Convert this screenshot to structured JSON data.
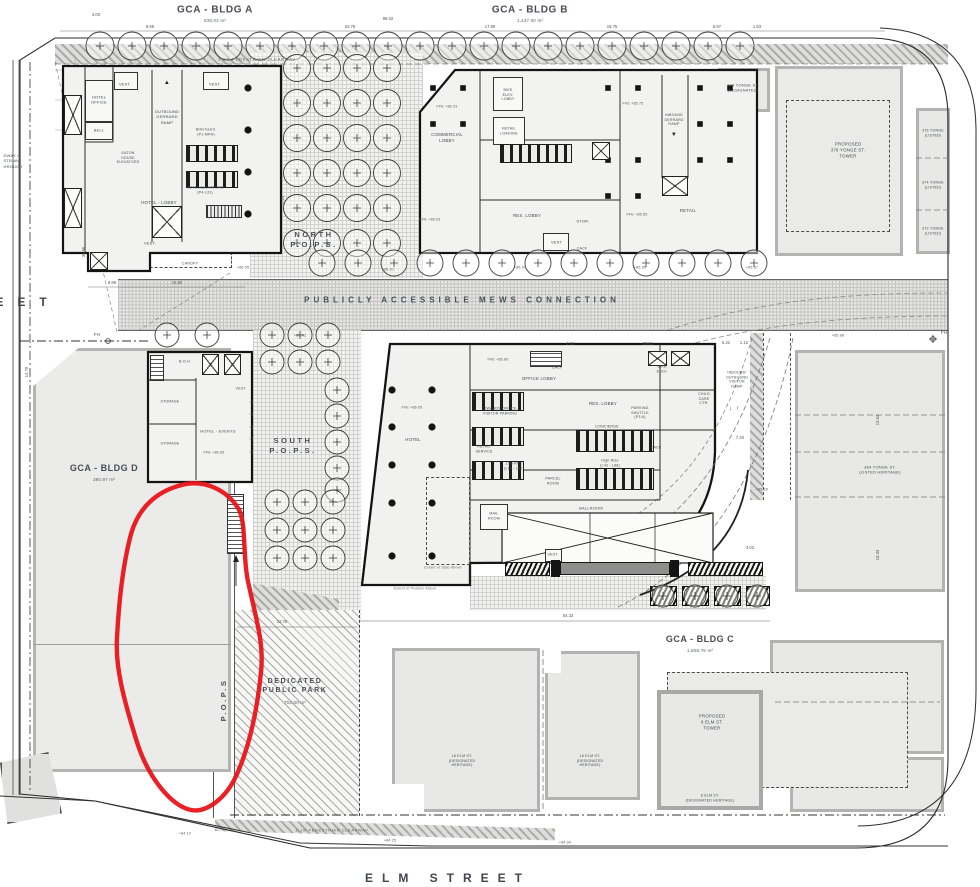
{
  "annotation": {
    "shape": "freehand-ellipse",
    "color": "#E8141A"
  },
  "palette": {
    "wall": "#141414",
    "heritage_border": "#AFAFAD",
    "paper": "#FFFFFF"
  },
  "headers": {
    "bldgA": "GCA - BLDG A",
    "bldgA_area": "838.02 m²",
    "bldgB": "GCA - BLDG B",
    "bldgB_area": "1,437.00 m²",
    "bldgC": "GCA - BLDG C",
    "bldgC_area": "1,808.76 m²",
    "bldgD": "GCA - BLDG D",
    "bldgD_area": "380.97 m²"
  },
  "streets": {
    "elm": "ELM STREET",
    "left_fragment": "EET",
    "left_note": "DWAY /\nSTRIAN\nHROUGH"
  },
  "zones": {
    "mews": "PUBLICLY ACCESSIBLE MEWS CONNECTION",
    "north_pops": "NORTH\nP.O.P.S.",
    "south_pops": "SOUTH\nP.O.P.S.",
    "west_pops": "P.O.P.S",
    "park": "DEDICATED\nPUBLIC PARK",
    "park_area": "702.00 m²",
    "clearway_top": "3.0m PEDESTRIAN CLEARWAY",
    "clearway_bottom": "2.1m PEDESTRIAN CLEARWAY",
    "fh": "FH"
  },
  "bldgA": {
    "rooms": {
      "hotel_office": "HOTEL\nOFFICE",
      "bell": "BELL",
      "vest_nw": "VEST.",
      "vest_ne": "VEST.",
      "vest_s": "VEST.",
      "outbound_ramp": "OUTBOUND\nGERRARD\nRAMP",
      "boh_elev": "BOH ELEV.\n(P1-MPH)",
      "eaton_elev": "EATON\nHOUSE\nELEVATORS",
      "hotel_elev": "HOTEL ELEVATORS\n(P4-L31)",
      "hotel_lobby": "HOTEL - LOBBY",
      "canopy": "CANOPY"
    }
  },
  "bldgB": {
    "rooms": {
      "commercial_lobby": "COMMERCIAL LOBBY",
      "bike_elev_lobby": "BIKE\nELEV.\nLOBBY",
      "retail_loading": "RETAIL\nLOADING",
      "res_lobby": "RES. LOBBY",
      "vest": "VEST.",
      "stor": "STOR.",
      "cacf": "CACF",
      "retail": "RETAIL",
      "inbound_ramp": "INBOUND\nGERRARD\nRAMP"
    }
  },
  "tower": {
    "rooms": {
      "hotel": "HOTEL",
      "office_lobby": "OFFICE LOBBY",
      "towards_office": "TOWARDS OFFICE /\nVISITOR PARKING",
      "retail_service": "RETAIL\nSERVICE",
      "low_rise": "Low-Rise\n(L17 - L42)",
      "high_rise": "High Rise\n(L43 - L88)",
      "res_lobby": "RES. LOBBY",
      "concierge": "CONCIERGE",
      "parking_shuttle": "PARKING\nSHUTTLE\n(P3-6)",
      "child_care": "CHILD\nCARE\nCTR.",
      "bike_elev": "BIKE\nELEV.",
      "cacf1": "CACF",
      "cacf2": "CACF",
      "parcel_room": "PARCEL\nROOM",
      "mail_room": "MAIL\nROOM",
      "ballroom": "BALLROOM",
      "vest": "VEST.",
      "visitor_ramp": "INBOUND/\nOUTBOUND\nVISITOR\nRAMP",
      "extent_podium": "Extent of Podium Above",
      "extent_slab": "Extent of Slab Above"
    }
  },
  "bldgD": {
    "rooms": {
      "boh": "B.O.H.",
      "storage1": "STORAGE",
      "storage2": "STORAGE",
      "events": "HOTEL - EVENTS",
      "vest": "VEST."
    }
  },
  "heritage": {
    "y378_designated": "378 YONGE ST.\n(DESIGNATED)",
    "y378_tower": "PROPOSED\n378 YONGE ST.\nTOWER",
    "y376": "376 YONGE\n(LISTED)",
    "y374": "374 YONGE\n(LISTED)",
    "y372": "372 YONGE\n(LISTED)",
    "y364": "364 YONGE ST.\n(LISTED HERITAGE)",
    "elm8_tower": "PROPOSED\n8 ELM ST.\nTOWER",
    "elm8": "8 ELM ST.\n(DESIGNATED HERITAGE)",
    "elm18": "18 ELM ST.\n(DESIGNATED\nHERITAGE)",
    "elm16": "16 ELM ST.\n(DESIGNATED\nHERITAGE)"
  },
  "dims": [
    "4.00",
    "8.95",
    "22.78",
    "98.02",
    "17.90",
    "18.75",
    "6.97",
    "1.63",
    "15.80",
    "8.85",
    "64.33",
    "22.75",
    "14.70",
    "36.96",
    "13.54",
    "18.33",
    "20.51",
    "4.91",
    "5.31",
    "1.12",
    "7.20",
    "3.02",
    "2.14"
  ],
  "elevations": [
    "FFE +86.03",
    "FFE +86.03",
    "FFE +85.75",
    "FFE +85.50",
    "FFE +86.05",
    "FFE +86.06",
    "FFE +85.80",
    "+86.05",
    "+86.01",
    "+86.00",
    "+85.85",
    "+85.67",
    "+86.02",
    "+85.98",
    "+85.20",
    "+84.25",
    "+84.06",
    "+84.12"
  ]
}
